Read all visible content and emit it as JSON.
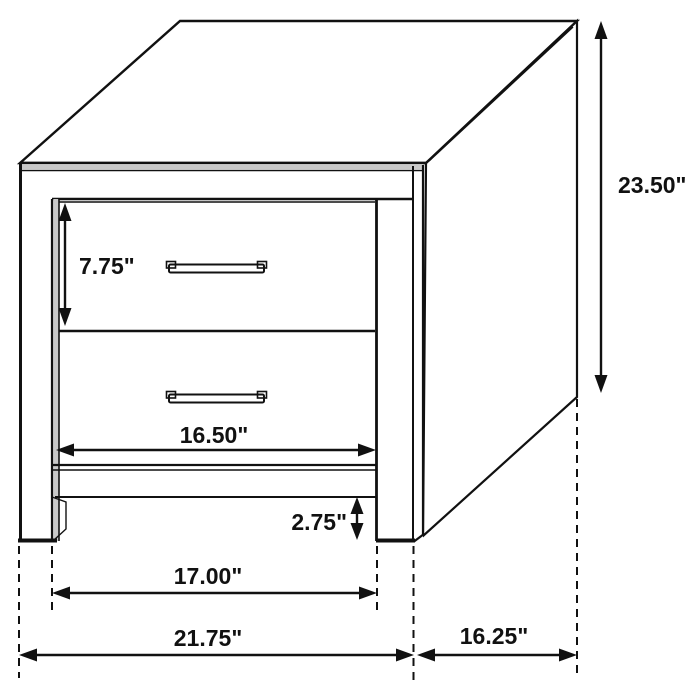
{
  "diagram": {
    "kind": "furniture-dimension-diagram",
    "colors": {
      "line": "#111111",
      "background": "#ffffff",
      "shading": "#c9c9c9"
    },
    "labels": {
      "overall_height": "23.50\"",
      "drawer_height": "7.75\"",
      "drawer_width": "16.50\"",
      "base_clearance": "2.75\"",
      "inner_leg_span": "17.00\"",
      "overall_width": "21.75\"",
      "side_depth": "16.25\""
    }
  }
}
